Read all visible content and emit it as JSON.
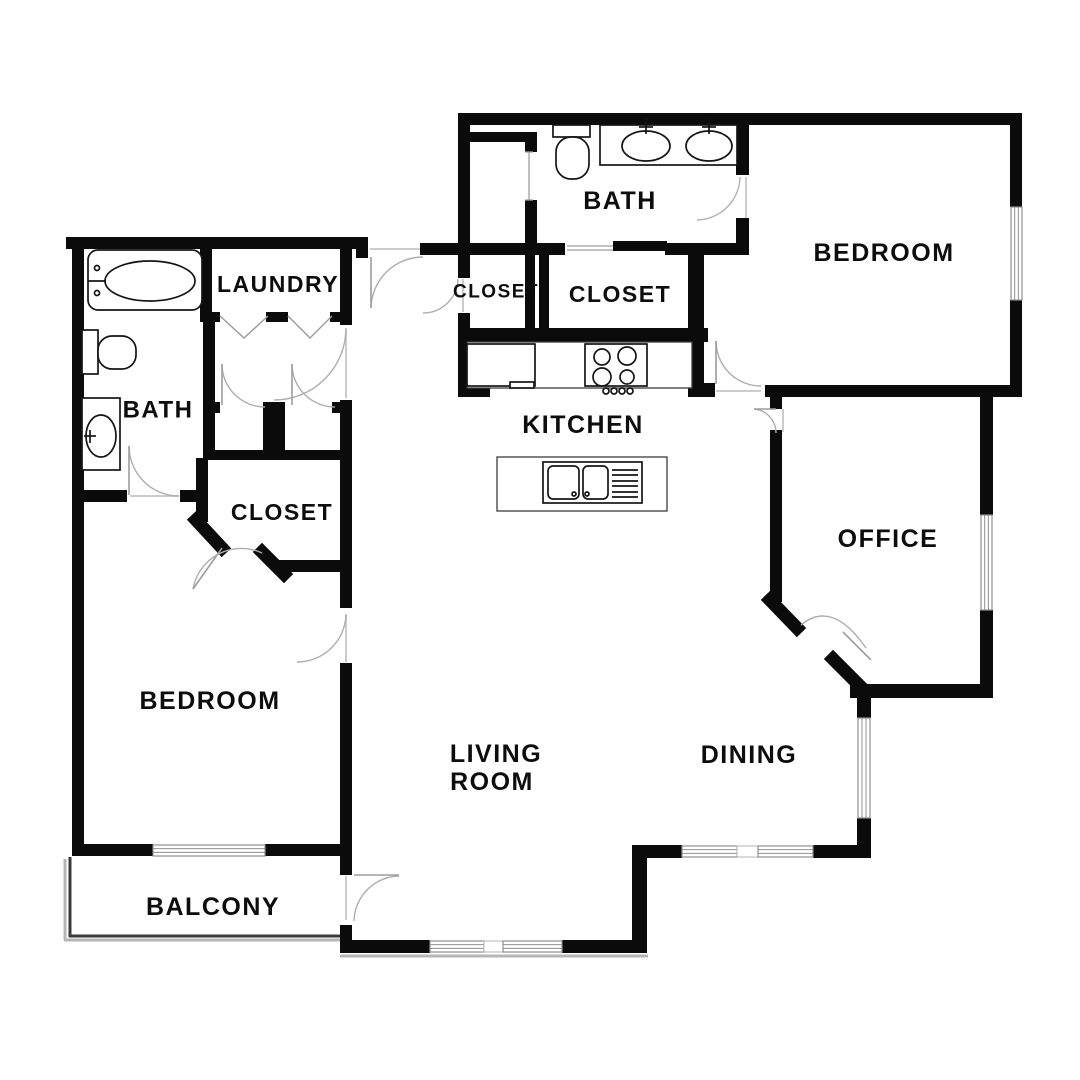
{
  "page": {
    "title": "Apartment Floor Plan"
  },
  "floorplan": {
    "width": 1080,
    "height": 1080,
    "colors": {
      "wall": "#0b0b0b",
      "door": "#aeaeae",
      "leaf": "#9d9d9d",
      "window_frame": "#8f8f8f",
      "mullion": "#b5b5b5",
      "fixture": "#151515",
      "counter": "#3c3c3c",
      "balcony": "#3a3a3a",
      "balcony_shadow": "#b5b5b5",
      "threshold": "#cccccc",
      "label": "#0d0d0d"
    },
    "rooms": [
      {
        "id": "bath-upper",
        "label": "BATH",
        "x": 620,
        "y": 201,
        "fs": 25
      },
      {
        "id": "bedroom-upper",
        "label": "BEDROOM",
        "x": 884,
        "y": 253,
        "fs": 25
      },
      {
        "id": "closet-small",
        "label": "CLOSET",
        "x": 496,
        "y": 292,
        "fs": 19
      },
      {
        "id": "closet-walkin",
        "label": "CLOSET",
        "x": 620,
        "y": 294,
        "fs": 23
      },
      {
        "id": "laundry",
        "label": "LAUNDRY",
        "x": 278,
        "y": 284,
        "fs": 23
      },
      {
        "id": "bath-left",
        "label": "BATH",
        "x": 158,
        "y": 410,
        "fs": 24
      },
      {
        "id": "kitchen",
        "label": "KITCHEN",
        "x": 583,
        "y": 425,
        "fs": 25
      },
      {
        "id": "closet-left",
        "label": "CLOSET",
        "x": 282,
        "y": 512,
        "fs": 23
      },
      {
        "id": "office",
        "label": "OFFICE",
        "x": 888,
        "y": 539,
        "fs": 25
      },
      {
        "id": "bedroom-left",
        "label": "BEDROOM",
        "x": 210,
        "y": 701,
        "fs": 25
      },
      {
        "id": "living-room-line1",
        "label": "LIVING",
        "x": 496,
        "y": 754,
        "fs": 25
      },
      {
        "id": "living-room-line2",
        "label": "ROOM",
        "x": 492,
        "y": 782,
        "fs": 25
      },
      {
        "id": "dining",
        "label": "DINING",
        "x": 749,
        "y": 755,
        "fs": 25
      },
      {
        "id": "balcony",
        "label": "BALCONY",
        "x": 213,
        "y": 907,
        "fs": 25
      }
    ],
    "walls": [
      [
        66,
        237,
        292,
        12
      ],
      [
        72,
        237,
        12,
        619
      ],
      [
        200,
        249,
        12,
        67
      ],
      [
        340,
        237,
        12,
        88
      ],
      [
        352,
        237,
        16,
        12
      ],
      [
        356,
        246,
        12,
        12
      ],
      [
        340,
        400,
        12,
        208
      ],
      [
        340,
        663,
        12,
        212
      ],
      [
        340,
        925,
        12,
        28
      ],
      [
        200,
        312,
        20,
        10
      ],
      [
        266,
        312,
        22,
        10
      ],
      [
        330,
        312,
        22,
        10
      ],
      [
        203,
        312,
        12,
        100
      ],
      [
        203,
        402,
        17,
        11
      ],
      [
        263,
        402,
        22,
        11
      ],
      [
        332,
        402,
        20,
        11
      ],
      [
        203,
        412,
        12,
        48
      ],
      [
        263,
        412,
        22,
        48
      ],
      [
        203,
        450,
        137,
        10
      ],
      [
        196,
        458,
        12,
        64
      ],
      [
        278,
        560,
        74,
        12
      ],
      [
        72,
        490,
        55,
        12
      ],
      [
        180,
        490,
        28,
        12
      ],
      [
        72,
        844,
        81,
        12
      ],
      [
        265,
        844,
        87,
        12
      ],
      [
        458,
        113,
        564,
        12
      ],
      [
        458,
        113,
        12,
        165
      ],
      [
        458,
        313,
        12,
        84
      ],
      [
        458,
        385,
        32,
        12
      ],
      [
        470,
        132,
        67,
        10
      ],
      [
        525,
        132,
        12,
        20
      ],
      [
        525,
        200,
        12,
        43
      ],
      [
        420,
        243,
        145,
        12
      ],
      [
        665,
        243,
        84,
        12
      ],
      [
        525,
        252,
        10,
        80
      ],
      [
        539,
        252,
        10,
        80
      ],
      [
        458,
        328,
        250,
        14
      ],
      [
        688,
        243,
        16,
        140
      ],
      [
        688,
        383,
        27,
        14
      ],
      [
        736,
        113,
        13,
        62
      ],
      [
        736,
        218,
        13,
        30
      ],
      [
        1010,
        113,
        12,
        94
      ],
      [
        1010,
        300,
        12,
        97
      ],
      [
        765,
        385,
        257,
        12
      ],
      [
        770,
        397,
        12,
        12
      ],
      [
        770,
        430,
        12,
        172
      ],
      [
        850,
        684,
        143,
        14
      ],
      [
        980,
        397,
        13,
        118
      ],
      [
        980,
        610,
        13,
        88
      ],
      [
        857,
        698,
        14,
        20
      ],
      [
        857,
        818,
        14,
        40
      ],
      [
        813,
        845,
        58,
        13
      ],
      [
        632,
        845,
        50,
        13
      ],
      [
        632,
        845,
        15,
        108
      ],
      [
        340,
        940,
        90,
        13
      ],
      [
        562,
        940,
        85,
        13
      ]
    ],
    "diagonals": [
      [
        196,
        520,
        222,
        548
      ],
      [
        262,
        552,
        284,
        574
      ],
      [
        770,
        600,
        797,
        628
      ],
      [
        833,
        659,
        858,
        684
      ]
    ],
    "windows": [
      {
        "x": 1011,
        "y": 207,
        "w": 11,
        "h": 93,
        "type": "window"
      },
      {
        "x": 981,
        "y": 515,
        "w": 11,
        "h": 95,
        "type": "window"
      },
      {
        "x": 858,
        "y": 718,
        "w": 12,
        "h": 100,
        "type": "window"
      },
      {
        "x": 682,
        "y": 846,
        "w": 55,
        "h": 11,
        "type": "window"
      },
      {
        "x": 737,
        "y": 846,
        "w": 21,
        "h": 11,
        "type": "mullion"
      },
      {
        "x": 758,
        "y": 846,
        "w": 55,
        "h": 11,
        "type": "window"
      },
      {
        "x": 430,
        "y": 941,
        "w": 54,
        "h": 11,
        "type": "window"
      },
      {
        "x": 484,
        "y": 941,
        "w": 19,
        "h": 11,
        "type": "mullion"
      },
      {
        "x": 503,
        "y": 941,
        "w": 59,
        "h": 11,
        "type": "window"
      },
      {
        "x": 153,
        "y": 845,
        "w": 112,
        "h": 11,
        "type": "window"
      }
    ],
    "doors": [
      {
        "id": "entry-door",
        "arc": "M 371 308 A 52 52 0 0 1 423 257",
        "leaf": [
          371,
          257,
          371,
          308
        ]
      },
      {
        "id": "closet-small-door",
        "arc": "M 458 279 A 35 35 0 0 1 423 313"
      },
      {
        "id": "hall-door",
        "arc": "M 346 328 A 72 72 0 0 1 274 400"
      },
      {
        "id": "closet-a-door",
        "arc": "M 222 364 A 43 43 0 0 0 265 407",
        "leaf": [
          222,
          364,
          222,
          405
        ]
      },
      {
        "id": "closet-b-door",
        "arc": "M 292 364 A 43 43 0 0 0 335 407",
        "leaf": [
          292,
          364,
          292,
          405
        ]
      },
      {
        "id": "closet-left-door",
        "arc": "M 193 589 A 49 49 0 0 1 262 553",
        "leaf": [
          222,
          548,
          193,
          589
        ]
      },
      {
        "id": "bath-left-door",
        "arc": "M 129 446 A 50 50 0 0 0 179 496",
        "leaf": [
          129,
          446,
          129,
          495
        ]
      },
      {
        "id": "bedroom-left-door",
        "arc": "M 346 615 A 49 49 0 0 1 297 662"
      },
      {
        "id": "balcony-door",
        "arc": "M 399 876 A 46 46 0 0 0 354 921",
        "leaf": [
          354,
          875,
          399,
          875
        ]
      },
      {
        "id": "bedroom-upper-door",
        "arc": "M 716 341 A 45 45 0 0 0 761 386",
        "leaf": [
          716,
          341,
          716,
          384
        ]
      },
      {
        "id": "bath-upper-door",
        "arc": "M 740 177 A 44 44 0 0 1 697 220"
      },
      {
        "id": "office-north-door",
        "arc": "M 754 409 A 24 24 0 0 1 776 433",
        "leaf": [
          754,
          409,
          776,
          409
        ]
      },
      {
        "id": "office-angled-door",
        "arc": "M 801 625 Q 832 599 866 648",
        "leaf": [
          843,
          632,
          871,
          660
        ]
      }
    ],
    "bifold_doors": [
      [
        220,
        316,
        244,
        338,
        268,
        316
      ],
      [
        288,
        316,
        310,
        338,
        332,
        316
      ]
    ],
    "thresholds": [
      [
        370,
        249,
        423,
        249
      ],
      [
        716,
        391,
        761,
        391
      ],
      [
        130,
        496,
        179,
        496
      ],
      [
        346,
        614,
        346,
        662
      ],
      [
        346,
        876,
        346,
        920
      ],
      [
        783,
        409,
        783,
        432
      ],
      [
        746,
        177,
        746,
        219
      ],
      [
        463,
        279,
        463,
        312
      ],
      [
        346,
        330,
        346,
        398
      ]
    ],
    "extra_gray": [
      [
        529,
        152,
        529,
        200
      ],
      [
        525,
        152,
        533,
        152
      ],
      [
        525,
        200,
        533,
        200
      ],
      [
        567,
        246,
        615,
        246
      ],
      [
        567,
        250,
        615,
        250
      ]
    ],
    "bypass_panel": {
      "x": 613,
      "y": 241,
      "w": 54,
      "h": 10
    },
    "balcony": {
      "dark": [
        [
          70,
          857,
          70,
          937
        ],
        [
          69,
          936,
          346,
          936
        ]
      ],
      "shadow": [
        [
          65,
          859,
          65,
          940
        ],
        [
          64,
          940,
          349,
          940
        ],
        [
          340,
          956,
          648,
          956
        ]
      ]
    },
    "fixtures": [
      {
        "t": "rect",
        "n": "bathtub",
        "x": 88,
        "y": 250,
        "w": 114,
        "h": 60,
        "rx": 10
      },
      {
        "t": "ellipse",
        "n": "bathtub-basin",
        "cx": 150,
        "cy": 281,
        "rx": 45,
        "ry": 20
      },
      {
        "t": "line",
        "n": "tub-faucet",
        "x1": 88,
        "y1": 281,
        "x2": 106,
        "y2": 281
      },
      {
        "t": "circle",
        "n": "tub-tap",
        "cx": 97,
        "cy": 268,
        "r": 2.5
      },
      {
        "t": "circle",
        "n": "tub-tap",
        "cx": 97,
        "cy": 293,
        "r": 2.5
      },
      {
        "t": "rect",
        "n": "toilet-tank",
        "x": 82,
        "y": 330,
        "w": 16,
        "h": 44
      },
      {
        "t": "rect",
        "n": "toilet-bowl",
        "x": 98,
        "y": 336,
        "w": 38,
        "h": 33,
        "rx": 14
      },
      {
        "t": "rect",
        "n": "vanity",
        "x": 82,
        "y": 398,
        "w": 38,
        "h": 72
      },
      {
        "t": "ellipse",
        "n": "sink",
        "cx": 101,
        "cy": 436,
        "rx": 15,
        "ry": 21
      },
      {
        "t": "line",
        "n": "sink-faucet",
        "x1": 84,
        "y1": 436,
        "x2": 96,
        "y2": 436
      },
      {
        "t": "line",
        "n": "sink-faucet",
        "x1": 90,
        "y1": 430,
        "x2": 90,
        "y2": 443
      },
      {
        "t": "rect",
        "n": "toilet-tank",
        "x": 553,
        "y": 125,
        "w": 37,
        "h": 12
      },
      {
        "t": "rect",
        "n": "toilet-bowl",
        "x": 556,
        "y": 137,
        "w": 33,
        "h": 42,
        "rx": 15
      },
      {
        "t": "rect",
        "n": "vanity",
        "x": 600,
        "y": 125,
        "w": 137,
        "h": 40
      },
      {
        "t": "ellipse",
        "n": "sink",
        "cx": 646,
        "cy": 146,
        "rx": 24,
        "ry": 15
      },
      {
        "t": "ellipse",
        "n": "sink",
        "cx": 709,
        "cy": 146,
        "rx": 23,
        "ry": 15
      },
      {
        "t": "line",
        "n": "sink-faucet",
        "x1": 646,
        "y1": 119,
        "x2": 646,
        "y2": 134
      },
      {
        "t": "line",
        "n": "sink-faucet",
        "x1": 639,
        "y1": 127,
        "x2": 653,
        "y2": 127
      },
      {
        "t": "line",
        "n": "sink-faucet",
        "x1": 709,
        "y1": 119,
        "x2": 709,
        "y2": 134
      },
      {
        "t": "line",
        "n": "sink-faucet",
        "x1": 702,
        "y1": 127,
        "x2": 716,
        "y2": 127
      },
      {
        "t": "rect",
        "n": "kitchen-counter",
        "x": 467,
        "y": 342,
        "w": 225,
        "h": 46,
        "thin": true
      },
      {
        "t": "rect",
        "n": "refrigerator",
        "x": 467,
        "y": 344,
        "w": 68,
        "h": 42
      },
      {
        "t": "rect",
        "n": "fridge-handle",
        "x": 510,
        "y": 382,
        "w": 24,
        "h": 6
      },
      {
        "t": "rect",
        "n": "stove",
        "x": 585,
        "y": 344,
        "w": 62,
        "h": 42
      },
      {
        "t": "circle",
        "n": "burner",
        "cx": 602,
        "cy": 357,
        "r": 8
      },
      {
        "t": "circle",
        "n": "burner",
        "cx": 627,
        "cy": 356,
        "r": 9
      },
      {
        "t": "circle",
        "n": "burner",
        "cx": 602,
        "cy": 377,
        "r": 9
      },
      {
        "t": "circle",
        "n": "burner",
        "cx": 627,
        "cy": 377,
        "r": 7
      },
      {
        "t": "circle",
        "n": "stove-knob",
        "cx": 606,
        "cy": 391,
        "r": 3
      },
      {
        "t": "circle",
        "n": "stove-knob",
        "cx": 614,
        "cy": 391,
        "r": 3
      },
      {
        "t": "circle",
        "n": "stove-knob",
        "cx": 622,
        "cy": 391,
        "r": 3
      },
      {
        "t": "circle",
        "n": "stove-knob",
        "cx": 630,
        "cy": 391,
        "r": 3
      },
      {
        "t": "rect",
        "n": "island",
        "x": 497,
        "y": 457,
        "w": 170,
        "h": 54,
        "thin": true
      },
      {
        "t": "rect",
        "n": "island-sink-unit",
        "x": 543,
        "y": 462,
        "w": 99,
        "h": 41
      },
      {
        "t": "rect",
        "n": "sink-basin",
        "x": 548,
        "y": 466,
        "w": 31,
        "h": 33,
        "rx": 5
      },
      {
        "t": "rect",
        "n": "sink-basin",
        "x": 583,
        "y": 466,
        "w": 25,
        "h": 33,
        "rx": 5
      },
      {
        "t": "circle",
        "n": "drain",
        "cx": 574,
        "cy": 494,
        "r": 2
      },
      {
        "t": "circle",
        "n": "drain",
        "cx": 587,
        "cy": 494,
        "r": 2
      },
      {
        "t": "line",
        "n": "drainboard-line",
        "x1": 612,
        "y1": 470,
        "x2": 638,
        "y2": 470
      },
      {
        "t": "line",
        "n": "drainboard-line",
        "x1": 612,
        "y1": 475,
        "x2": 638,
        "y2": 475
      },
      {
        "t": "line",
        "n": "drainboard-line",
        "x1": 612,
        "y1": 481,
        "x2": 638,
        "y2": 481
      },
      {
        "t": "line",
        "n": "drainboard-line",
        "x1": 612,
        "y1": 486,
        "x2": 638,
        "y2": 486
      },
      {
        "t": "line",
        "n": "drainboard-line",
        "x1": 612,
        "y1": 492,
        "x2": 638,
        "y2": 492
      },
      {
        "t": "line",
        "n": "drainboard-line",
        "x1": 612,
        "y1": 497,
        "x2": 638,
        "y2": 497
      }
    ]
  }
}
